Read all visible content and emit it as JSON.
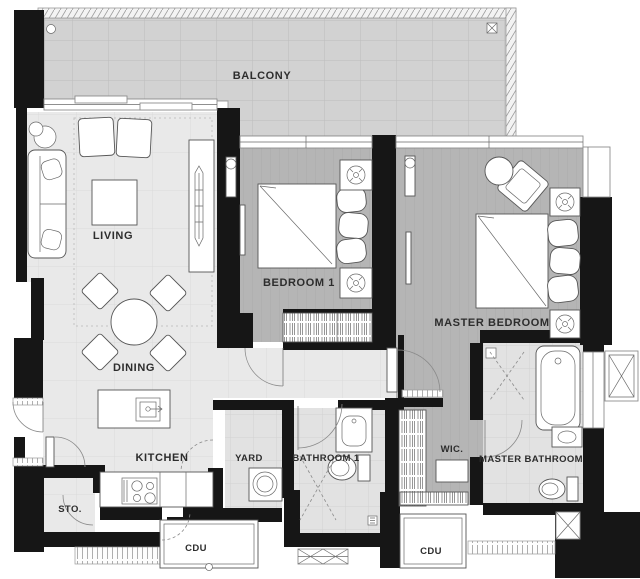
{
  "plan": {
    "type": "apartment-floor-plan",
    "rooms": {
      "balcony": {
        "label": "BALCONY"
      },
      "living": {
        "label": "LIVING"
      },
      "dining": {
        "label": "DINING"
      },
      "kitchen": {
        "label": "KITCHEN"
      },
      "storage": {
        "label": "STO."
      },
      "yard": {
        "label": "YARD"
      },
      "bathroom1": {
        "label": "BATHROOM 1"
      },
      "bedroom1": {
        "label": "BEDROOM 1"
      },
      "master_bedroom": {
        "label": "MASTER BEDROOM"
      },
      "wic": {
        "label": "WIC."
      },
      "master_bathroom": {
        "label": "MASTER BATHROOM"
      },
      "cdu_left": {
        "label": "CDU"
      },
      "cdu_right": {
        "label": "CDU"
      }
    },
    "colors": {
      "background": "#ffffff",
      "wall": "#161616",
      "balcony_floor": "#d2d2d2",
      "tile_floor": "#e9e9e9",
      "wood_floor": "#b5b5b5",
      "bath_floor": "#e2e2e2",
      "furniture_line": "#565656"
    },
    "furniture_icons": [
      "sofa-icon",
      "floor-lamp-icon",
      "armchair-icon",
      "coffee-table-icon",
      "tv-console-icon",
      "dining-table-icon",
      "dining-chair-icon",
      "kitchen-island-icon",
      "kitchen-sink-icon",
      "stove-icon",
      "double-bed-icon",
      "pillow-icon",
      "nightstand-icon",
      "table-lamp-icon",
      "wardrobe-icon",
      "lounge-chair-icon",
      "side-table-icon",
      "washing-machine-icon",
      "vanity-sink-icon",
      "toilet-icon",
      "bathtub-icon",
      "shower-icon",
      "closet-rail-icon",
      "bench-icon",
      "door-swing-icon",
      "floor-drain-icon",
      "louver-vent-icon",
      "shaft-icon"
    ]
  }
}
